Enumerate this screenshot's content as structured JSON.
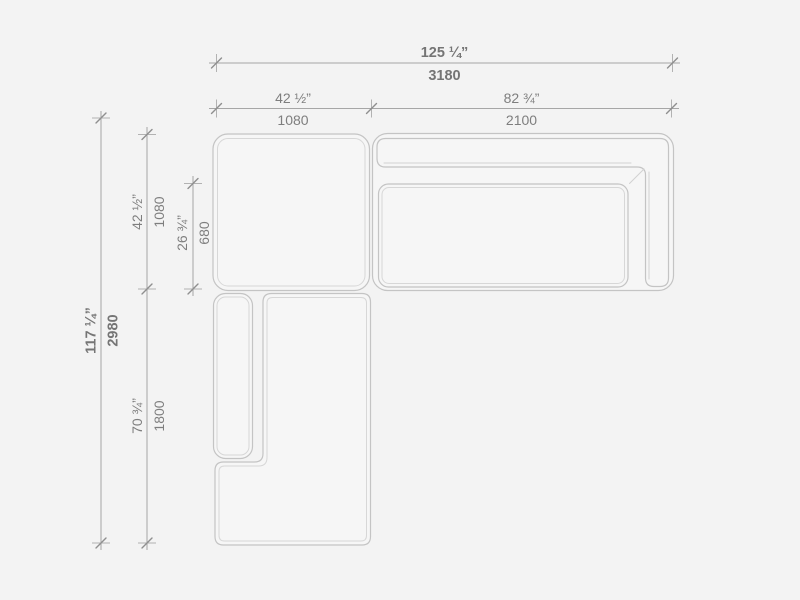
{
  "diagram": {
    "kind": "sectional-sofa-top-view-dimension-drawing",
    "colors": {
      "background": "#f3f3f3",
      "piece_outline": "#c4c4c4",
      "seam_line": "#d7d7d7",
      "dimension_line": "#a6a6a6",
      "tick": "#8f8f8f",
      "label_text": "#7e7e7e"
    },
    "dims": {
      "overall_width_in": "125 ¼”",
      "overall_width_mm": "3180",
      "left_width_in": "42 ½”",
      "left_width_mm": "1080",
      "right_width_in": "82 ¾”",
      "right_width_mm": "2100",
      "overall_depth_in": "117 ¼”",
      "overall_depth_mm": "2980",
      "top_depth_in": "42 ½”",
      "top_depth_mm": "1080",
      "seat_depth_in": "26 ¾”",
      "seat_depth_mm": "680",
      "chaise_length_in": "70 ¾”",
      "chaise_length_mm": "1800"
    }
  }
}
